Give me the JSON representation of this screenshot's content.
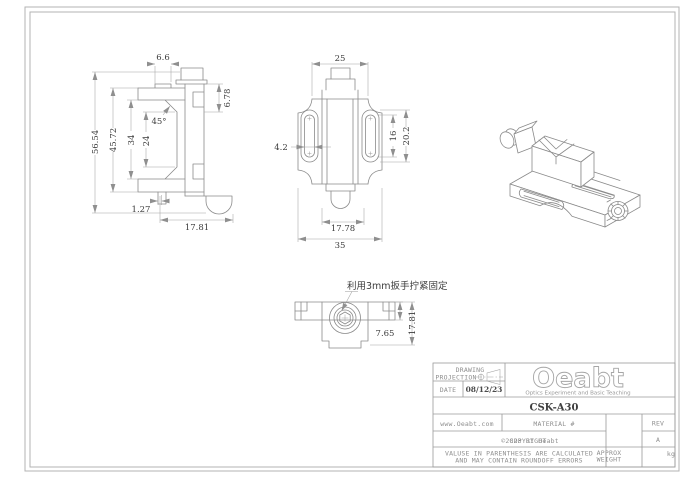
{
  "side_view": {
    "dims": {
      "top_width": "6.6",
      "overall_height": "56.54",
      "height_outer": "45.72",
      "height_mid": "34",
      "height_inner": "24",
      "chamfer_angle": "45°",
      "top_right_height": "6.78",
      "bottom_offset": "1.27",
      "bottom_width": "17.81"
    }
  },
  "front_view": {
    "dims": {
      "top_width": "25",
      "slot_width": "4.2",
      "slot_inner_length": "16",
      "slot_outer_length": "20.2",
      "bottom_width": "17.78",
      "overall_width": "35"
    }
  },
  "bottom_view": {
    "annotation": "利用3mm扳手拧紧固定",
    "dims": {
      "bar_height": "7.65",
      "overall_depth": "17.81"
    }
  },
  "title_block": {
    "projection_line1": "DRAWING",
    "projection_line2": "PROJECTION",
    "date_label": "DATE",
    "date_value": "08/12/23",
    "logo_text": "Oeabt",
    "logo_tagline": "Optics Experiment and Basic Teaching",
    "part_number": "CSK-A30",
    "website": "www.Oeabt.com",
    "material_label": "MATERIAL #",
    "rev_label": "REV",
    "copyright_main": "COPYRIGHT",
    "copyright_sub": "©2023 BY Oeabt",
    "rev_value": "A",
    "disclaimer_line1": "VALUSE IN PARENTHESIS ARE CALCULATED",
    "disclaimer_line2": "AND MAY CONTAIN ROUNDOFF ERRORS",
    "weight_label_line1": "APPROX",
    "weight_label_line2": "WEIGHT",
    "weight_unit": "kg"
  }
}
